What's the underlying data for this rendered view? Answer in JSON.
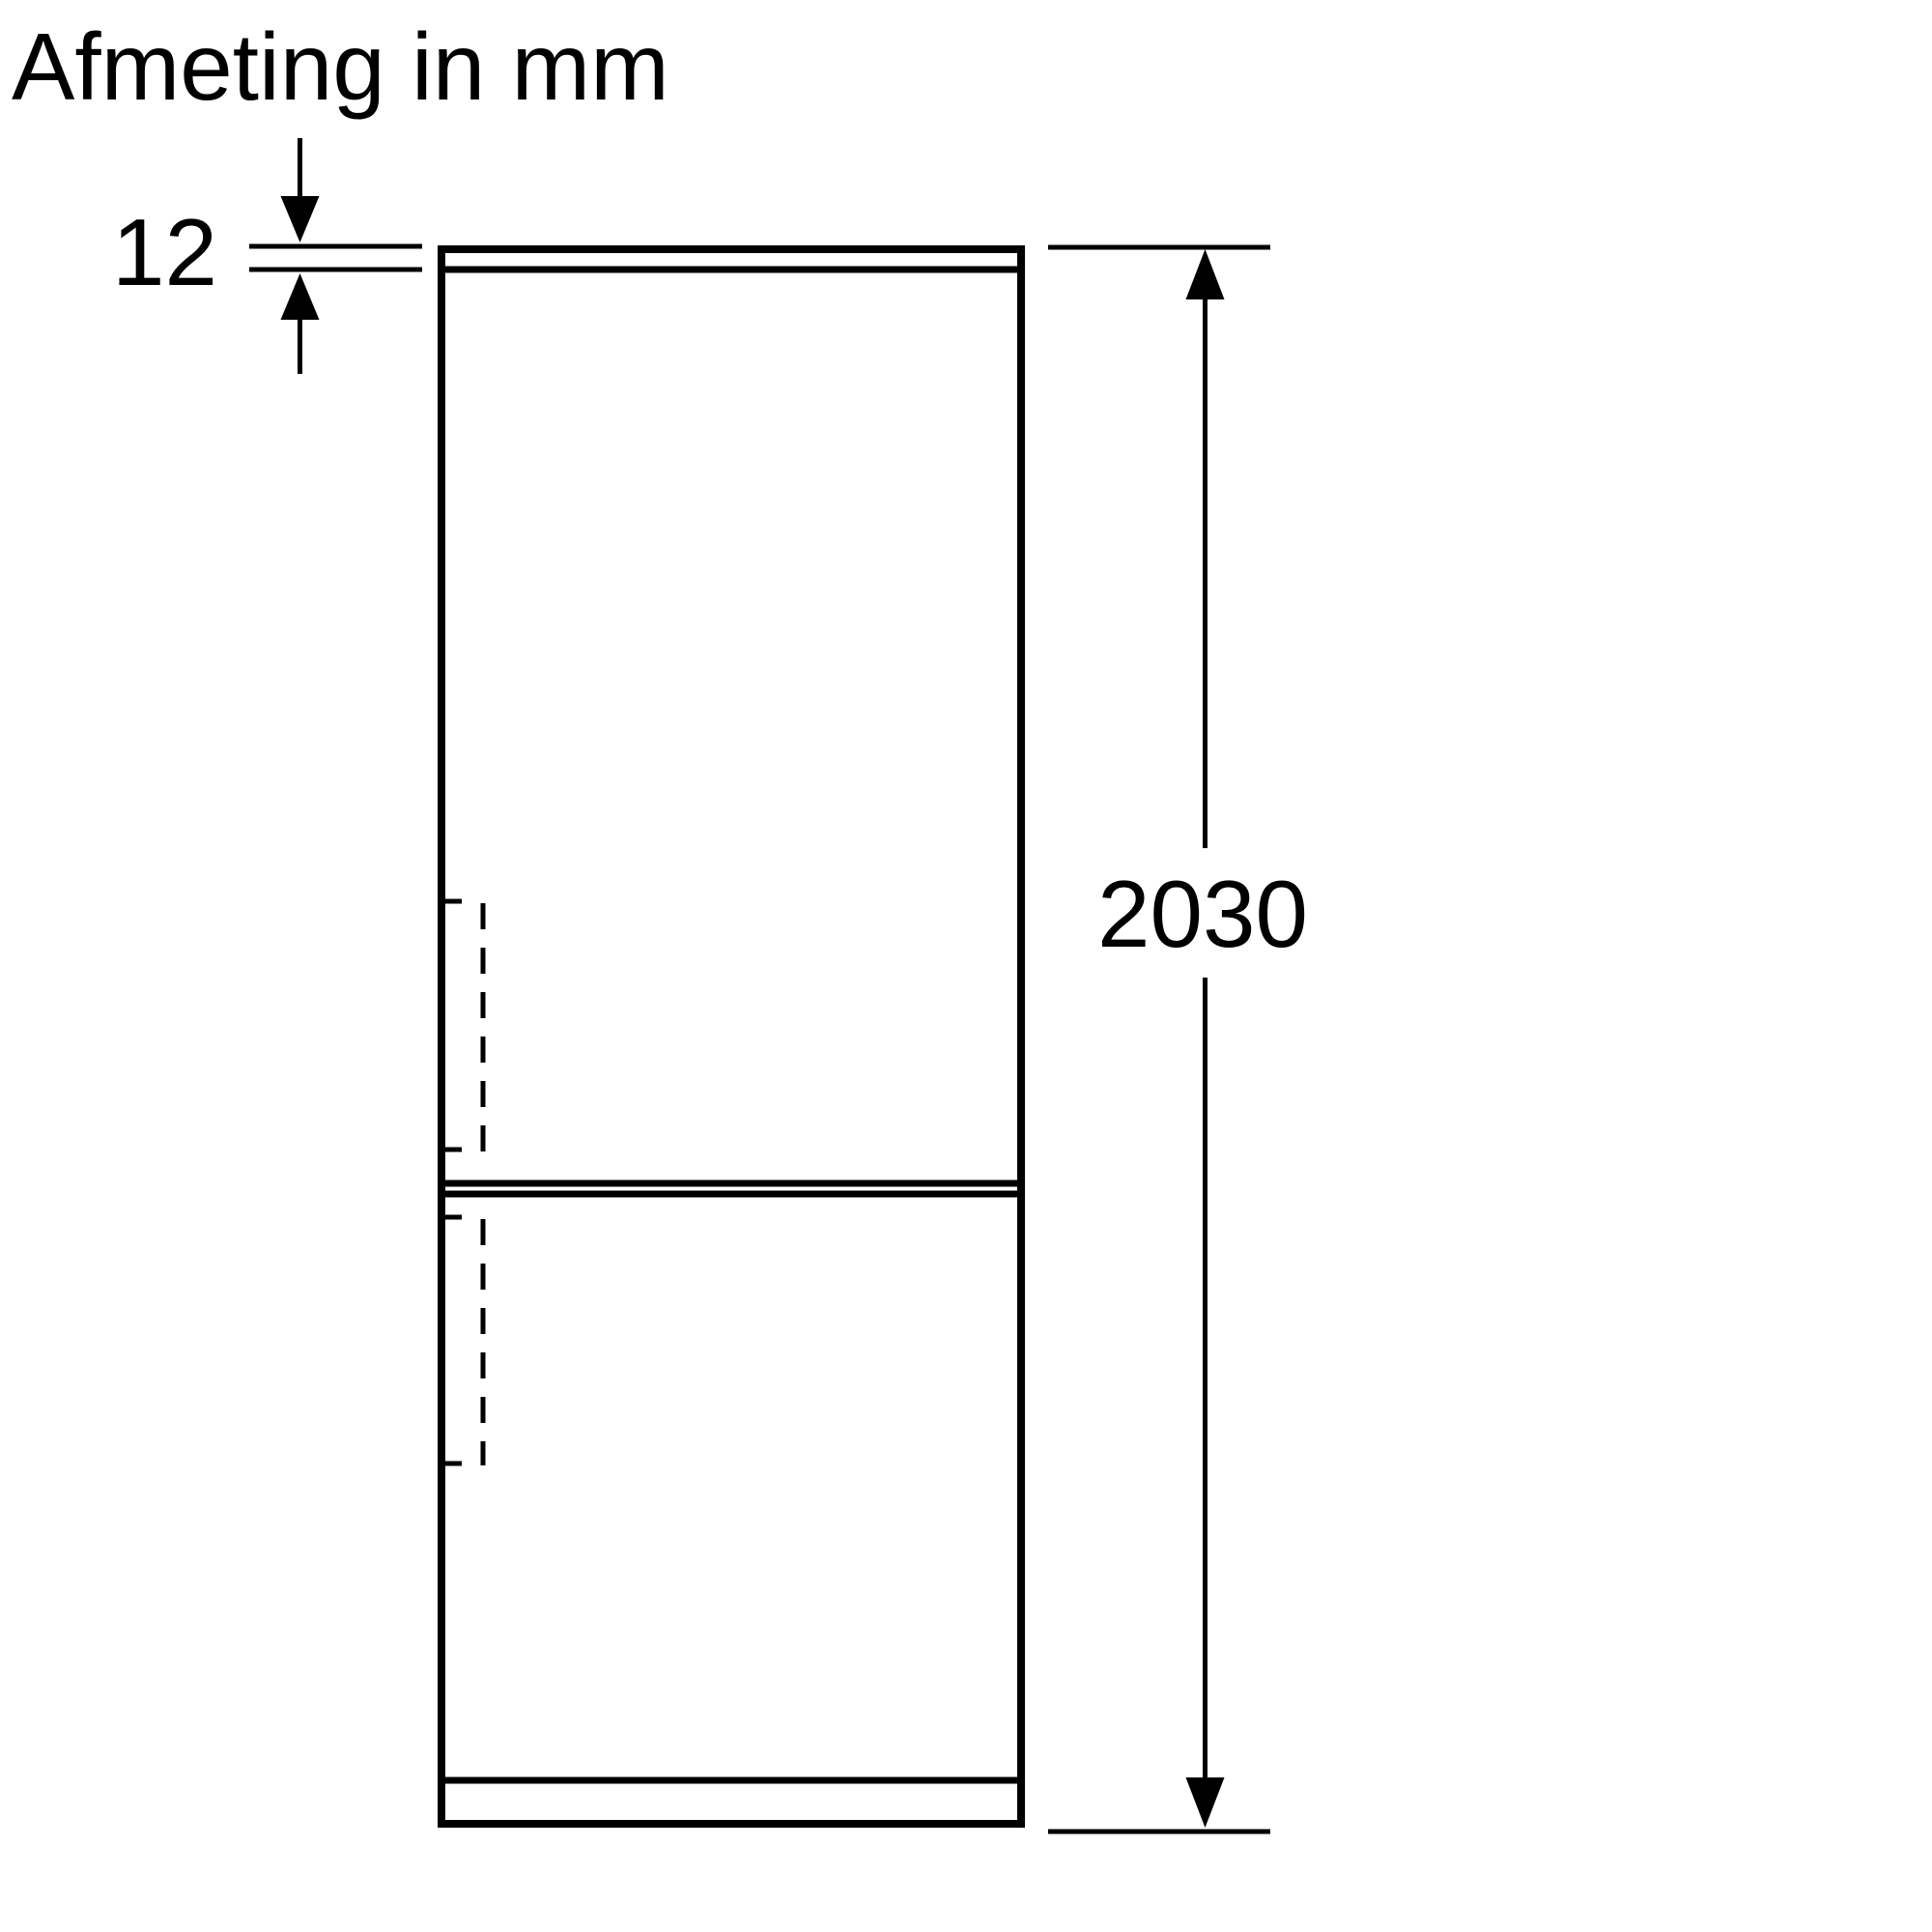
{
  "title": "Afmeting in mm",
  "dimensions": {
    "top_panel": {
      "label": "12",
      "value": 12,
      "unit": "mm"
    },
    "height": {
      "label": "2030",
      "value": 2030,
      "unit": "mm"
    }
  },
  "colors": {
    "line": "#000000",
    "background": "#ffffff"
  }
}
